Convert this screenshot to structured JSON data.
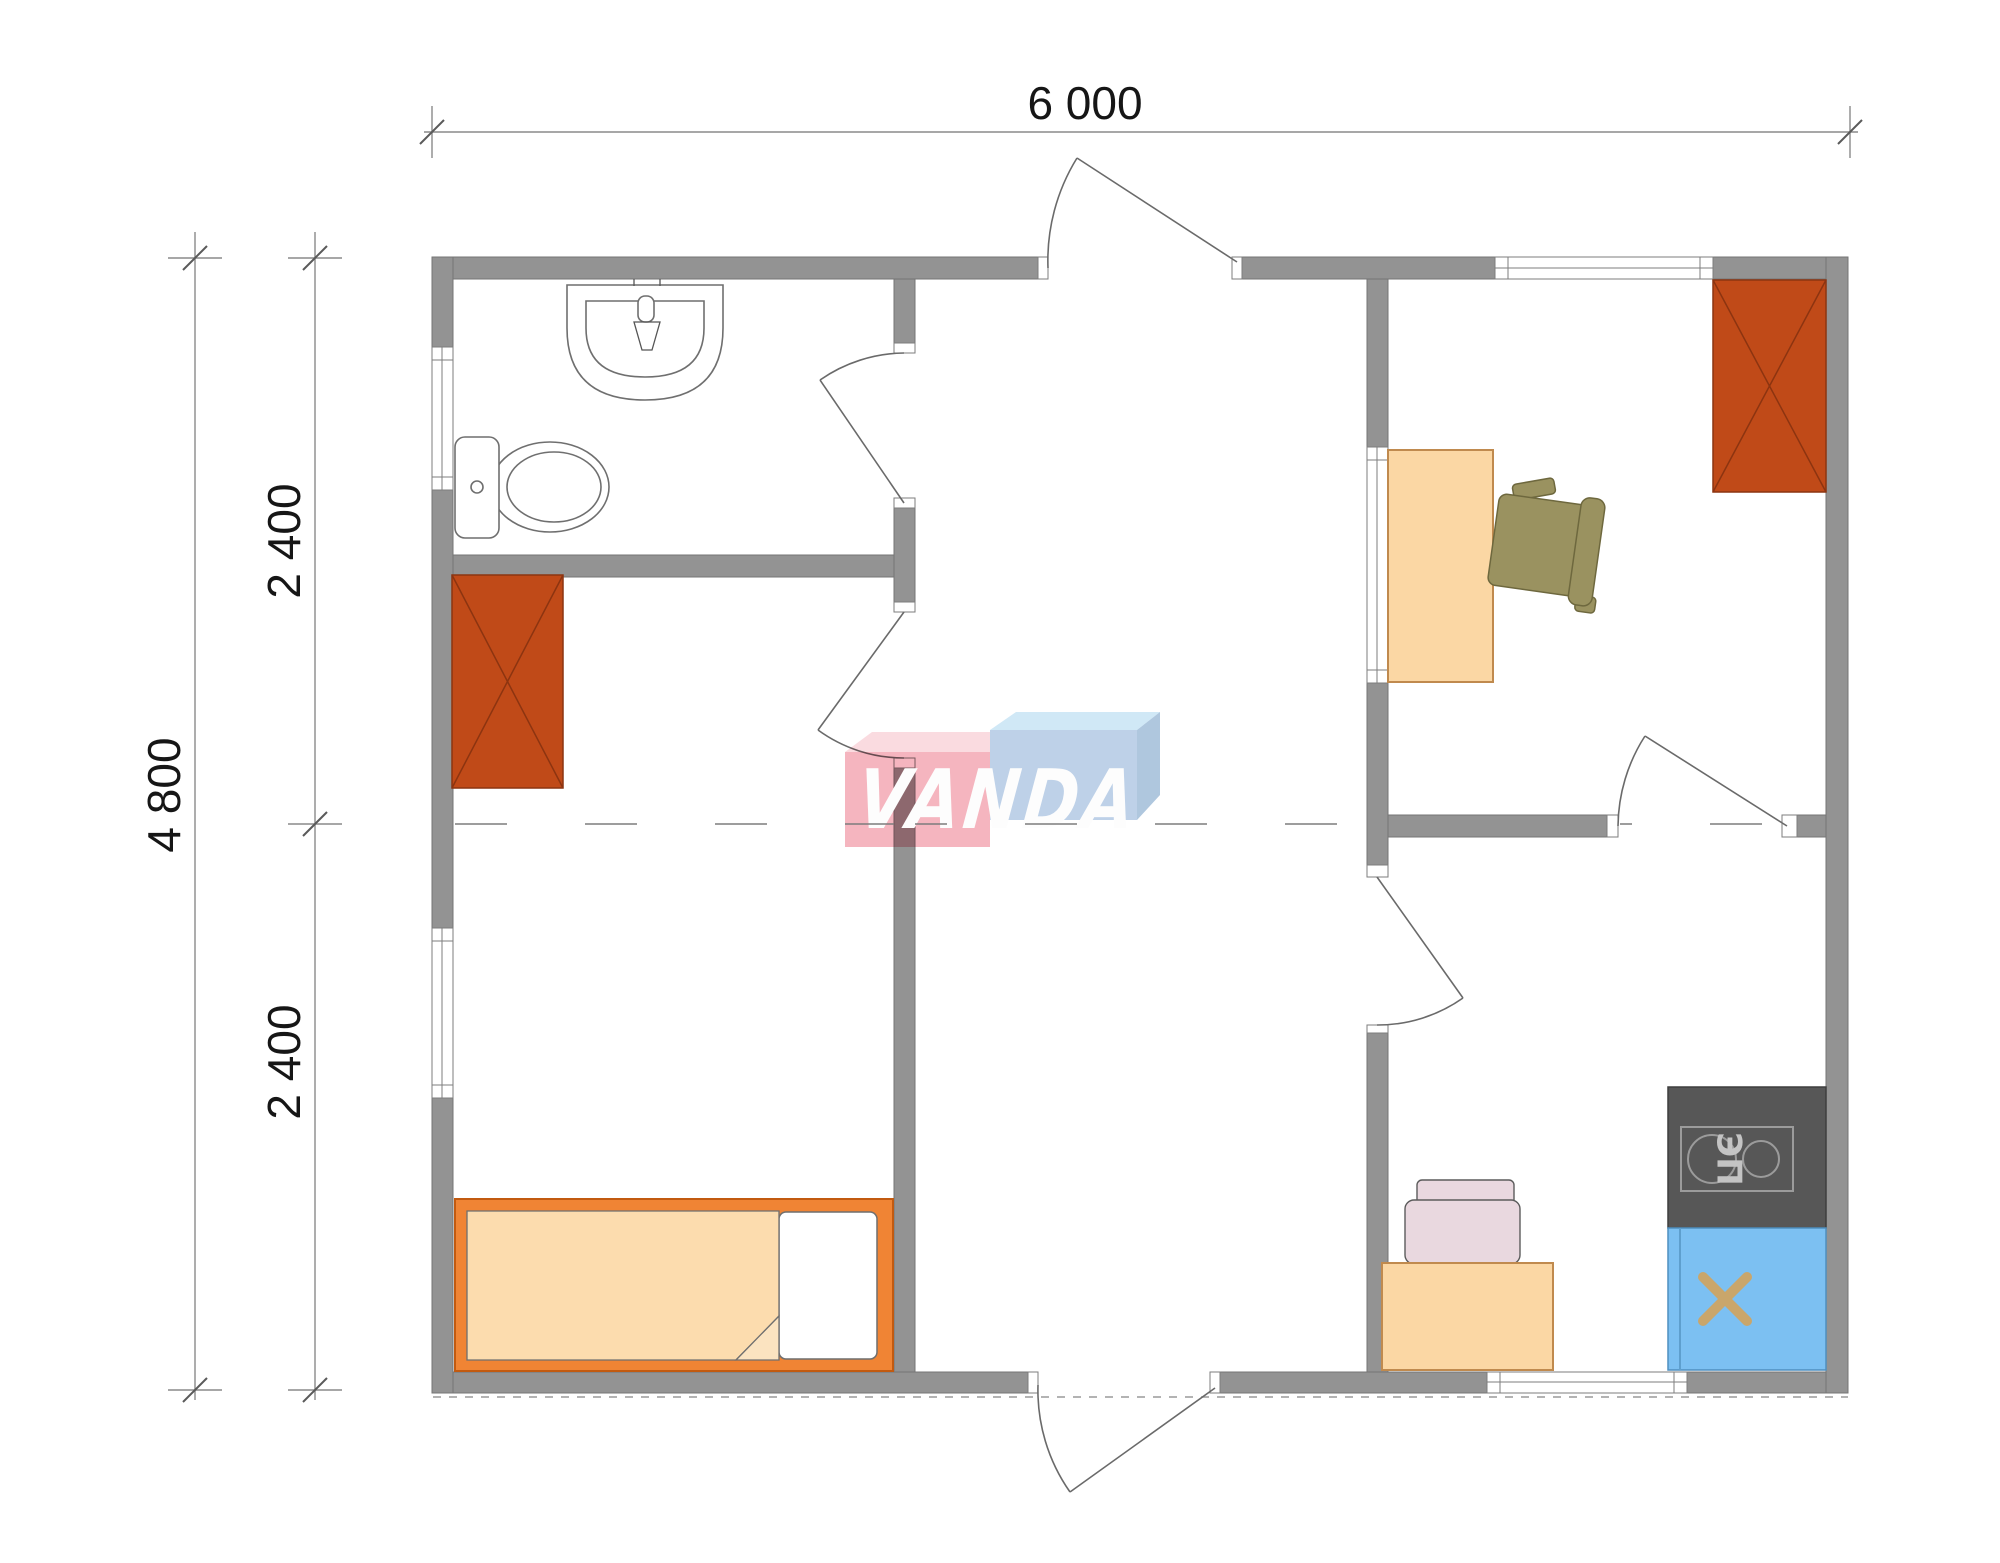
{
  "dimensions": {
    "width_label": "6 000",
    "height_label": "4 800",
    "upper_segment_label": "2 400",
    "lower_segment_label": "2 400"
  },
  "watermark": {
    "text": "VANDA",
    "pink": "#F5AFBA",
    "pink_top": "#FAD8DE",
    "blue": "#B9CDE6",
    "blue_top": "#CCE6F6",
    "blue_side": "#A8C2DC"
  },
  "appliances": {
    "stove_label": "ЭП"
  },
  "colors": {
    "wall": "#939393",
    "wardrobe": "#C04A18",
    "wardrobe_line": "#8C3410",
    "desk_peach": "#FBD7A4",
    "bed_frame": "#F08434",
    "mattress": "#FCDCAE",
    "fold": "#FBE3C0",
    "chair_olive": "#9A9260",
    "chair_pink": "#E9D8DF",
    "stove_dark": "#575757",
    "sink_blue": "#7CC0F2",
    "faucet_beige": "#C9A66B"
  }
}
